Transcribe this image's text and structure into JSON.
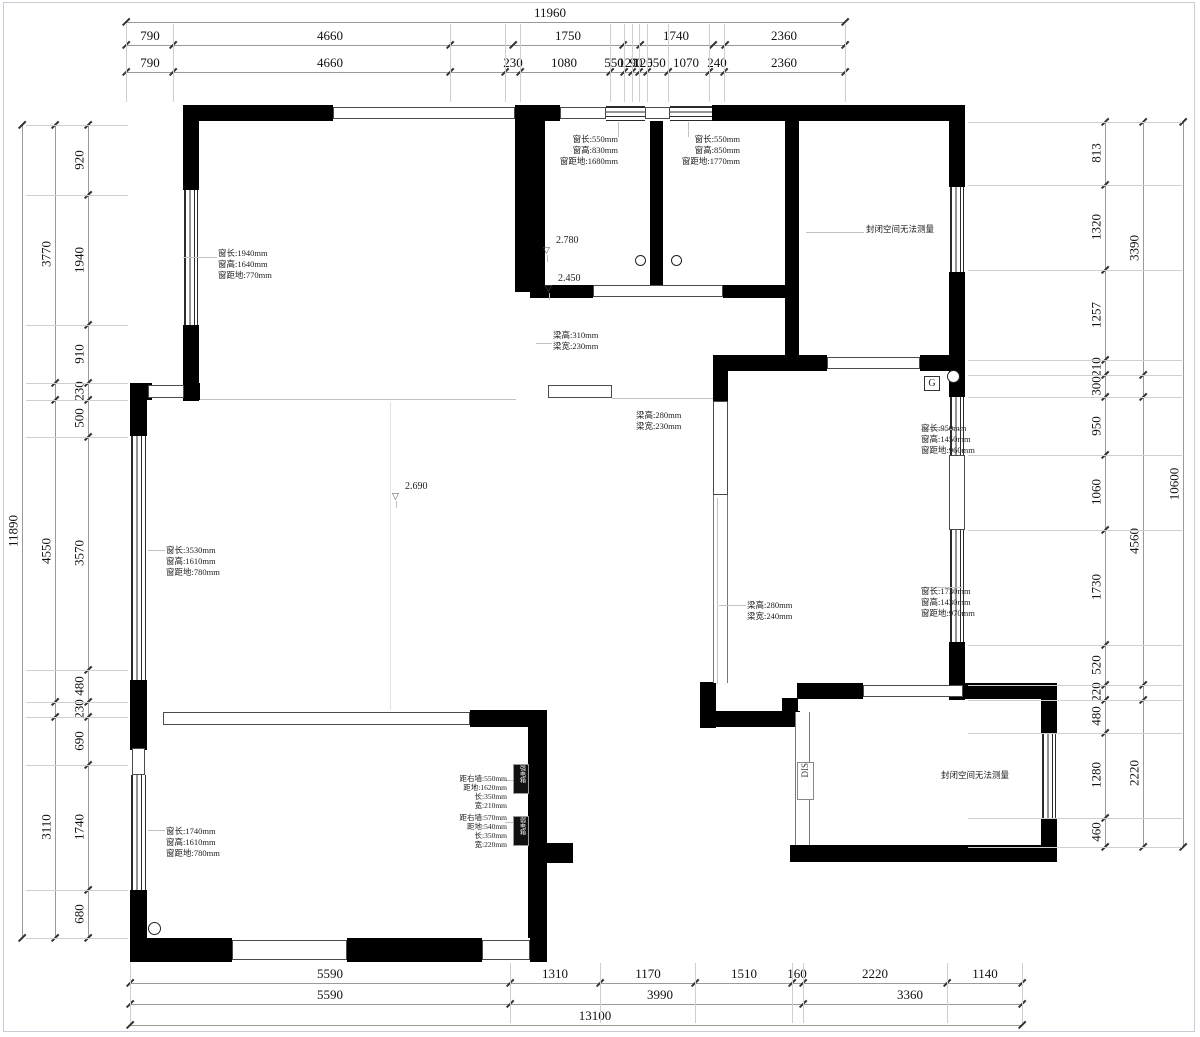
{
  "page": {
    "colors": {
      "wall": "#000000",
      "dim_text": "#111111",
      "dim_line": "#9a9a9a",
      "frame": "#c9ccd4",
      "leader": "#c2c2c2"
    }
  },
  "dim_chains": {
    "top": [
      {
        "y": 22,
        "x1": 126,
        "x2": 845,
        "ticks": [
          126,
          845
        ],
        "labels": [
          {
            "t": "11960",
            "x": 550
          }
        ]
      },
      {
        "y": 45,
        "x1": 126,
        "x2": 845,
        "ticks": [
          126,
          173,
          450,
          513,
          623,
          640,
          713,
          725,
          845
        ],
        "labels": [
          {
            "t": "790",
            "x": 150
          },
          {
            "t": "4660",
            "x": 330
          },
          {
            "t": "1750",
            "x": 568
          },
          {
            "t": "1740",
            "x": 676
          },
          {
            "t": "2360",
            "x": 784
          }
        ]
      },
      {
        "y": 72,
        "x1": 126,
        "x2": 845,
        "ticks": [
          126,
          173,
          450,
          505,
          520,
          610,
          624,
          632,
          639,
          647,
          668,
          709,
          724,
          845
        ],
        "labels": [
          {
            "t": "790",
            "x": 150
          },
          {
            "t": "4660",
            "x": 330
          },
          {
            "t": "230",
            "x": 513
          },
          {
            "t": "1080",
            "x": 564
          },
          {
            "t": "550",
            "x": 614
          },
          {
            "t": "120",
            "x": 628
          },
          {
            "t": "90",
            "x": 636
          },
          {
            "t": "120",
            "x": 643
          },
          {
            "t": "550",
            "x": 656
          },
          {
            "t": "1070",
            "x": 686
          },
          {
            "t": "240",
            "x": 717
          },
          {
            "t": "2360",
            "x": 784
          }
        ]
      }
    ],
    "bottom": [
      {
        "y": 983,
        "x1": 130,
        "x2": 1022,
        "ticks": [
          130,
          510,
          600,
          695,
          792,
          803,
          947,
          1022
        ],
        "labels": [
          {
            "t": "5590",
            "x": 330
          },
          {
            "t": "1310",
            "x": 555
          },
          {
            "t": "1170",
            "x": 648
          },
          {
            "t": "1510",
            "x": 744
          },
          {
            "t": "160",
            "x": 797
          },
          {
            "t": "2220",
            "x": 875
          },
          {
            "t": "1140",
            "x": 985
          }
        ]
      },
      {
        "y": 1004,
        "x1": 130,
        "x2": 1022,
        "ticks": [
          130,
          510,
          803,
          1022
        ],
        "labels": [
          {
            "t": "5590",
            "x": 330
          },
          {
            "t": "3990",
            "x": 660
          },
          {
            "t": "3360",
            "x": 910
          }
        ]
      },
      {
        "y": 1025,
        "x1": 130,
        "x2": 1022,
        "ticks": [
          130,
          1022
        ],
        "labels": [
          {
            "t": "13100",
            "x": 595
          }
        ]
      }
    ],
    "left": [
      {
        "x": 88,
        "y1": 125,
        "y2": 938,
        "ticks": [
          125,
          195,
          325,
          383,
          400,
          437,
          670,
          702,
          717,
          765,
          890,
          938
        ],
        "labels": [
          {
            "t": "920",
            "y": 160
          },
          {
            "t": "1940",
            "y": 260
          },
          {
            "t": "910",
            "y": 354
          },
          {
            "t": "230",
            "y": 391
          },
          {
            "t": "500",
            "y": 418
          },
          {
            "t": "3570",
            "y": 553
          },
          {
            "t": "480",
            "y": 686
          },
          {
            "t": "230",
            "y": 709
          },
          {
            "t": "690",
            "y": 741
          },
          {
            "t": "1740",
            "y": 827
          },
          {
            "t": "680",
            "y": 914
          }
        ]
      },
      {
        "x": 55,
        "y1": 125,
        "y2": 938,
        "ticks": [
          125,
          383,
          400,
          702,
          717,
          938
        ],
        "labels": [
          {
            "t": "3770",
            "y": 254
          },
          {
            "t": "4550",
            "y": 551
          },
          {
            "t": "3110",
            "y": 827
          }
        ]
      },
      {
        "x": 22,
        "y1": 125,
        "y2": 938,
        "ticks": [
          125,
          938
        ],
        "labels": [
          {
            "t": "11890",
            "y": 531
          }
        ]
      }
    ],
    "right": [
      {
        "x": 1105,
        "y1": 122,
        "y2": 847,
        "ticks": [
          122,
          185,
          270,
          360,
          375,
          397,
          455,
          530,
          645,
          685,
          700,
          733,
          818,
          847
        ],
        "labels": [
          {
            "t": "813",
            "y": 153
          },
          {
            "t": "1320",
            "y": 227
          },
          {
            "t": "1257",
            "y": 315
          },
          {
            "t": "210",
            "y": 367
          },
          {
            "t": "300",
            "y": 386
          },
          {
            "t": "950",
            "y": 426
          },
          {
            "t": "1060",
            "y": 492
          },
          {
            "t": "1730",
            "y": 587
          },
          {
            "t": "520",
            "y": 665
          },
          {
            "t": "220",
            "y": 692
          },
          {
            "t": "480",
            "y": 716
          },
          {
            "t": "1280",
            "y": 775
          },
          {
            "t": "460",
            "y": 832
          }
        ]
      },
      {
        "x": 1143,
        "y1": 122,
        "y2": 847,
        "ticks": [
          122,
          375,
          397,
          685,
          700,
          847
        ],
        "labels": [
          {
            "t": "3390",
            "y": 248
          },
          {
            "t": "4560",
            "y": 541
          },
          {
            "t": "2220",
            "y": 773
          }
        ]
      },
      {
        "x": 1183,
        "y1": 122,
        "y2": 847,
        "ticks": [
          122,
          847
        ],
        "labels": [
          {
            "t": "10600",
            "y": 484
          }
        ]
      }
    ]
  },
  "annotations": [
    {
      "id": "window-top-left",
      "x": 218,
      "y": 248,
      "align": "left",
      "lines": [
        "窗长:1940mm",
        "窗高:1640mm",
        "窗距地:770mm"
      ]
    },
    {
      "id": "window-bath-left",
      "x": 618,
      "y": 134,
      "align": "right",
      "lines": [
        "窗长:550mm",
        "窗高:830mm",
        "窗距地:1680mm"
      ]
    },
    {
      "id": "window-bath-right",
      "x": 740,
      "y": 134,
      "align": "right",
      "lines": [
        "窗长:550mm",
        "窗高:850mm",
        "窗距地:1770mm"
      ]
    },
    {
      "id": "closed-space-top",
      "x": 900,
      "y": 224,
      "align": "center",
      "lines": [
        "封闭空间无法测量"
      ]
    },
    {
      "id": "beam-a",
      "x": 553,
      "y": 330,
      "align": "left",
      "lines": [
        "梁高:310mm",
        "梁宽:230mm"
      ]
    },
    {
      "id": "beam-b",
      "x": 636,
      "y": 410,
      "align": "left",
      "lines": [
        "梁高:280mm",
        "梁宽:230mm"
      ]
    },
    {
      "id": "window-right-upper",
      "x": 921,
      "y": 423,
      "align": "left",
      "lines": [
        "窗长:950mm",
        "窗高:1450mm",
        "窗距地:960mm"
      ]
    },
    {
      "id": "window-right-lower",
      "x": 921,
      "y": 586,
      "align": "left",
      "lines": [
        "窗长:1730mm",
        "窗高:1430mm",
        "窗距地:970mm"
      ]
    },
    {
      "id": "beam-c",
      "x": 747,
      "y": 600,
      "align": "left",
      "lines": [
        "梁高:280mm",
        "梁宽:240mm"
      ]
    },
    {
      "id": "window-left-main",
      "x": 166,
      "y": 545,
      "align": "left",
      "lines": [
        "窗长:3530mm",
        "窗高:1610mm",
        "窗距地:780mm"
      ]
    },
    {
      "id": "window-left-lower",
      "x": 166,
      "y": 826,
      "align": "left",
      "lines": [
        "窗长:1740mm",
        "窗高:1610mm",
        "窗距地:780mm"
      ]
    },
    {
      "id": "ebox-upper",
      "x": 507,
      "y": 774,
      "align": "right",
      "small": true,
      "lines": [
        "距右墙:550mm",
        "距地:1620mm",
        "长:350mm",
        "宽:210mm"
      ]
    },
    {
      "id": "ebox-lower",
      "x": 507,
      "y": 813,
      "align": "right",
      "small": true,
      "lines": [
        "距右墙:570mm",
        "距地:540mm",
        "长:350mm",
        "宽:220mm"
      ]
    },
    {
      "id": "closed-space-bottom",
      "x": 975,
      "y": 770,
      "align": "center",
      "lines": [
        "封闭空间无法测量"
      ]
    }
  ],
  "elevations": [
    {
      "value": "2.780",
      "x": 556,
      "y": 235
    },
    {
      "value": "2.450",
      "x": 558,
      "y": 273
    },
    {
      "value": "2.690",
      "x": 405,
      "y": 481
    }
  ],
  "markers": {
    "g": {
      "label": "G"
    },
    "dis": {
      "label": "DIS"
    },
    "ebox_top": {
      "label": "强电箱"
    },
    "ebox_bottom": {
      "label": "弱电箱"
    }
  },
  "circles": [
    {
      "x": 635,
      "y": 255,
      "d": 11
    },
    {
      "x": 671,
      "y": 255,
      "d": 11
    },
    {
      "x": 947,
      "y": 370,
      "d": 13
    },
    {
      "x": 148,
      "y": 922,
      "d": 13
    }
  ]
}
